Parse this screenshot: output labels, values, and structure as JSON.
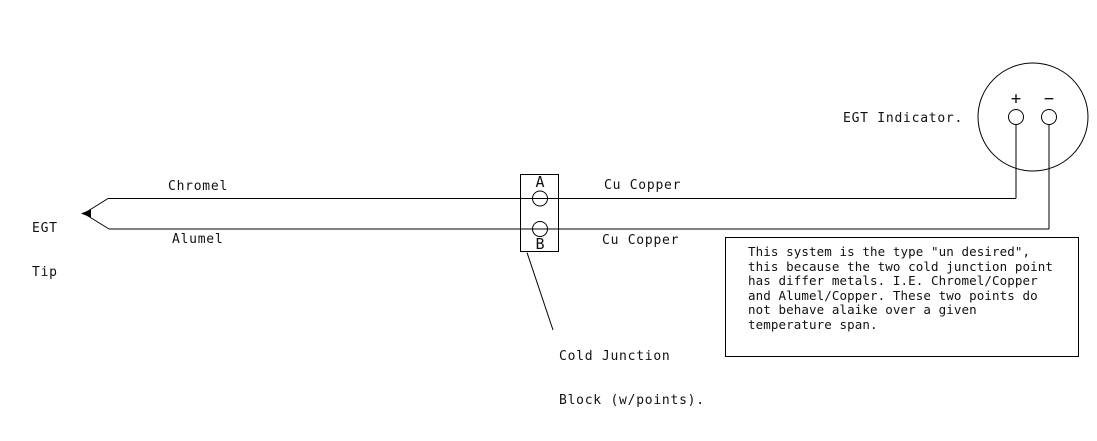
{
  "canvas": {
    "background_color": "#ffffff",
    "ink_color": "#000000",
    "text_color": "#111111"
  },
  "probe": {
    "label_lines": [
      "EGT",
      "Tip"
    ]
  },
  "wires": {
    "top": {
      "label": "Chromel",
      "right_label": "Cu Copper"
    },
    "bottom": {
      "label": "Alumel",
      "right_label": "Cu Copper"
    }
  },
  "junction_block": {
    "terminal_top": "A",
    "terminal_bottom": "B",
    "label_lines": [
      "Cold Junction",
      "Block (w/points)."
    ]
  },
  "indicator": {
    "label": "EGT Indicator.",
    "positive_symbol": "+",
    "negative_symbol": "−"
  },
  "note": {
    "lines": [
      "This system is the type \"un desired\",",
      "this because the two cold junction point",
      "has differ metals. I.E. Chromel/Copper",
      "and Alumel/Copper. These two points do",
      "not behave alaike over a given",
      "temperature span."
    ]
  }
}
